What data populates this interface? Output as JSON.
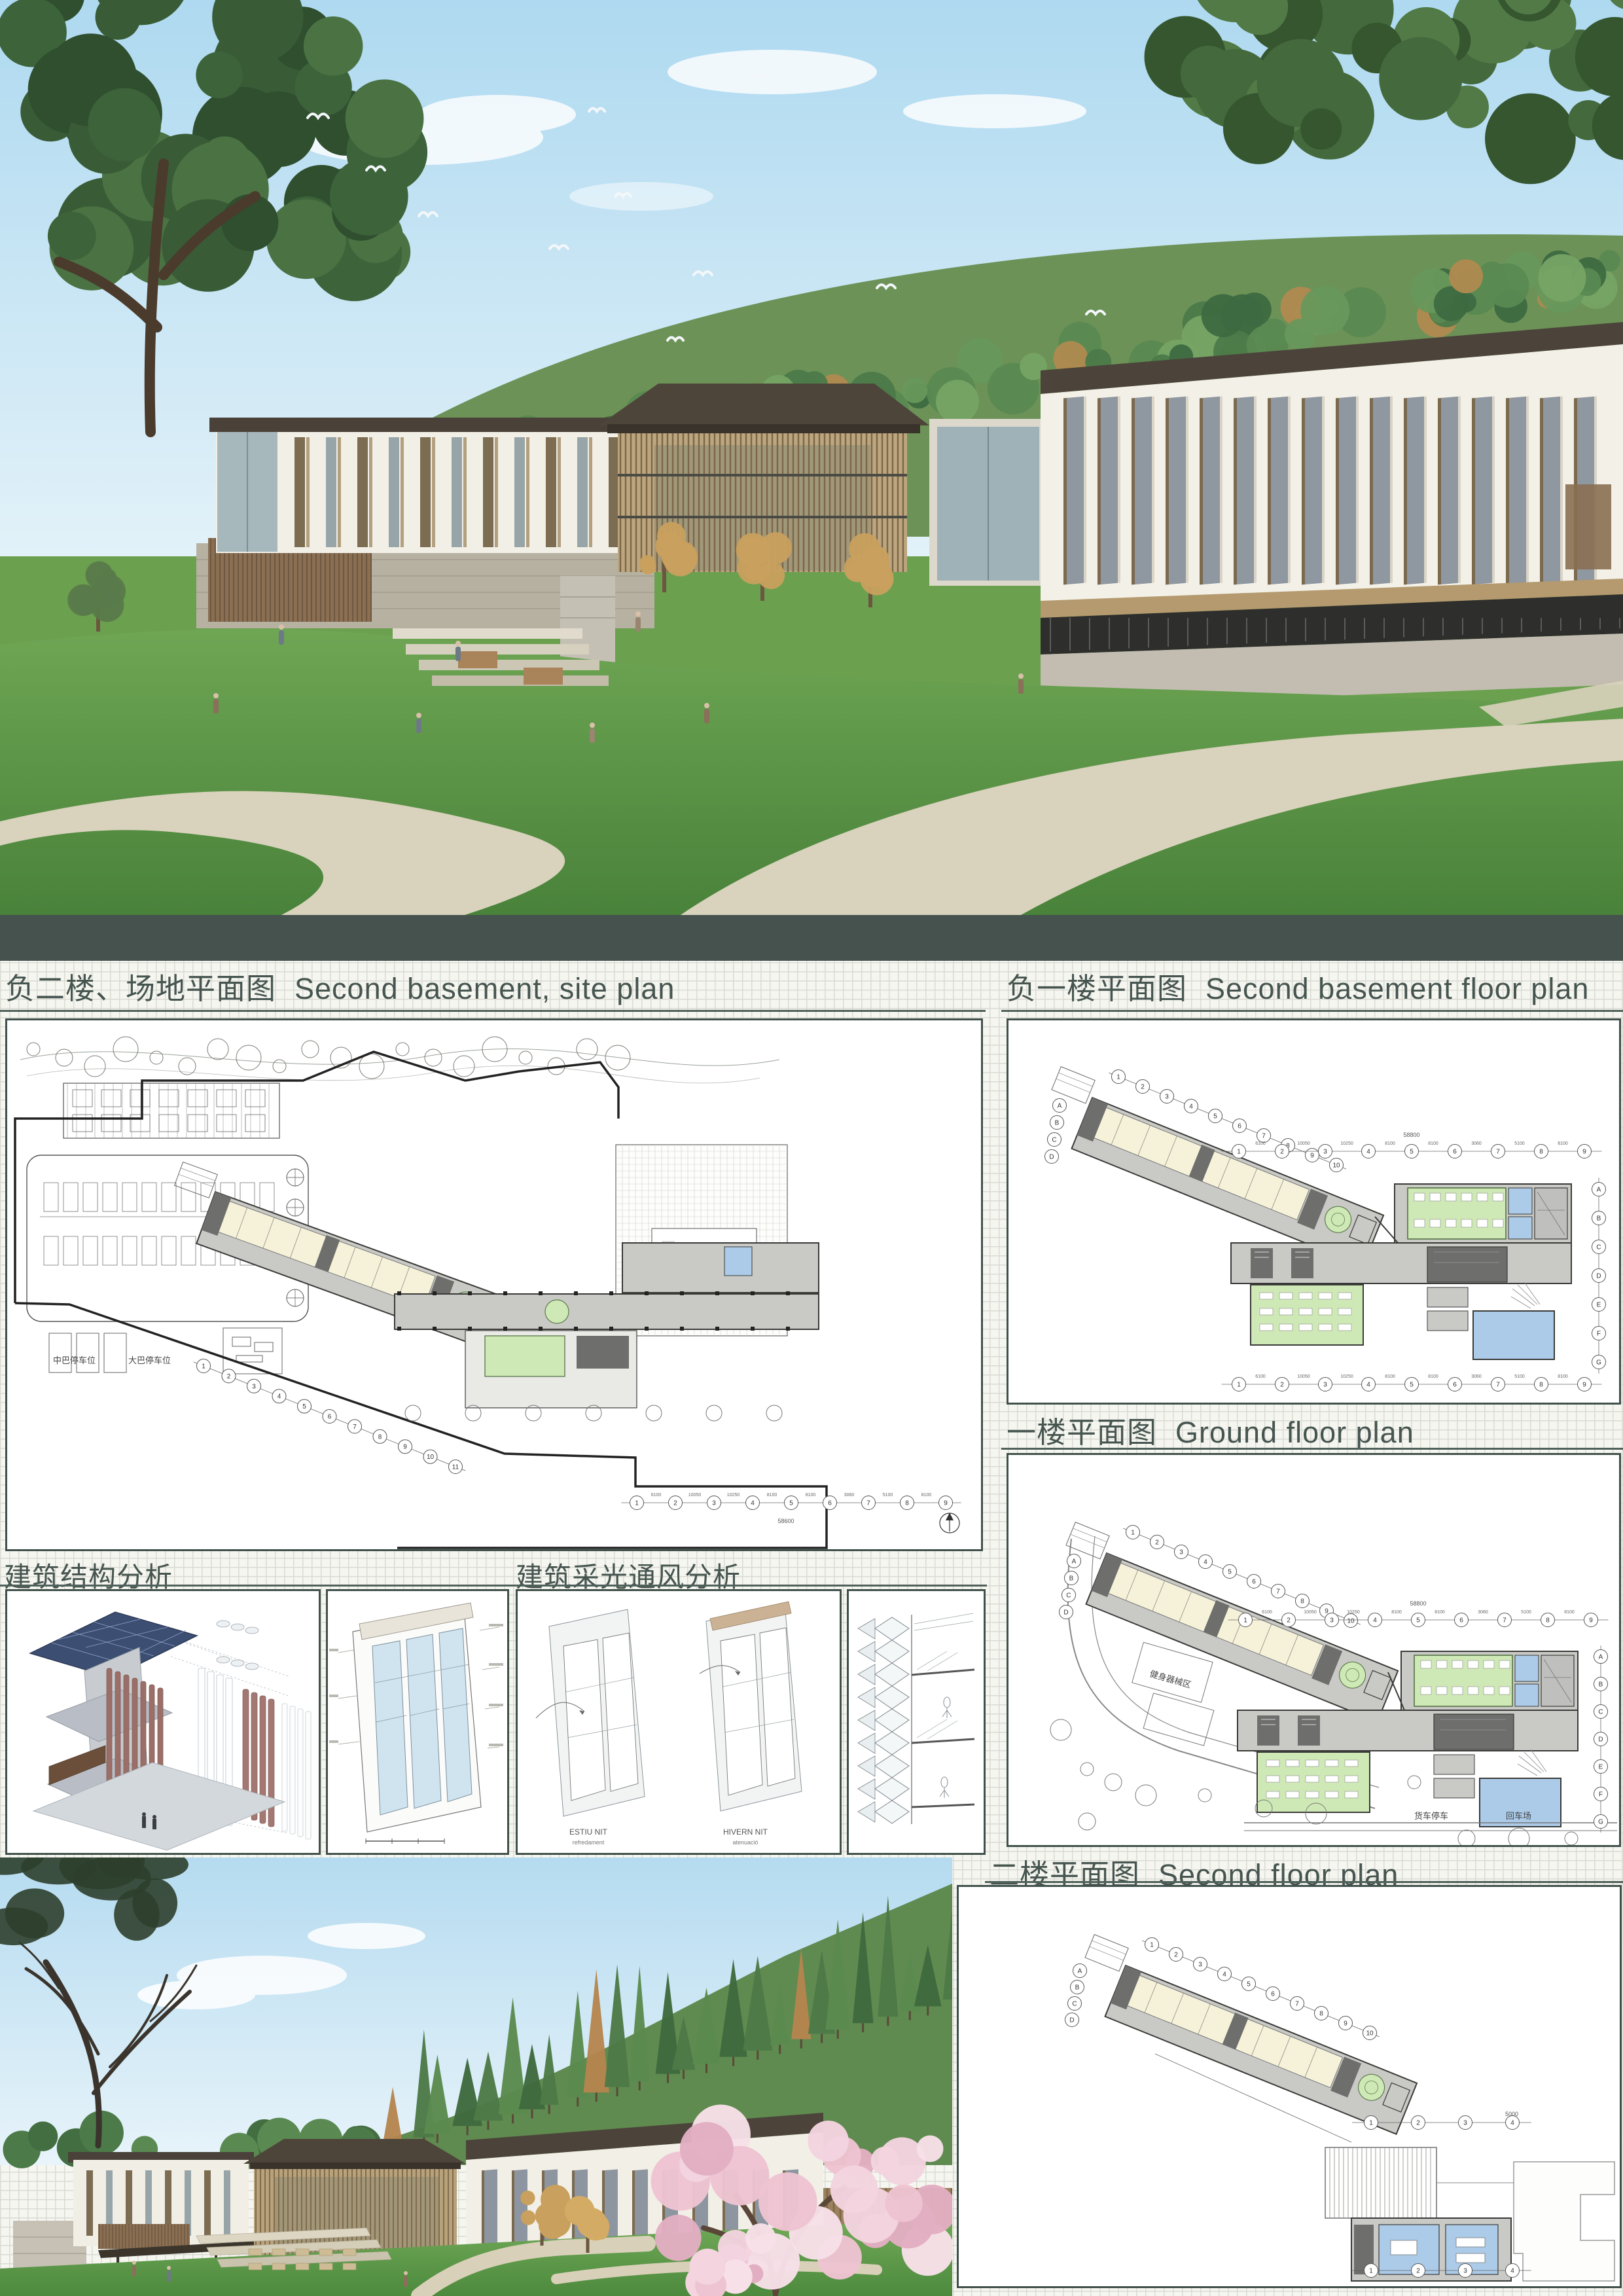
{
  "titles": {
    "site_zh": "负二楼、场地平面图",
    "site_en": "Second basement, site plan",
    "b1_zh": "负一楼平面图",
    "b1_en": "Second basement floor plan",
    "ground_zh": "一楼平面图",
    "ground_en": "Ground floor plan",
    "second_zh": "二楼平面图",
    "second_en": "Second floor plan",
    "structure_zh": "建筑结构分析",
    "daylight_zh": "建筑采光通风分析"
  },
  "site_plan": {
    "minibus_parking": "中巴停车位",
    "bus_parking": "大巴停车位",
    "total_dim": "58600"
  },
  "ground_plan": {
    "fitness_area": "健身器械区",
    "truck_parking": "货车停车",
    "turnaround": "回车场"
  },
  "plans": {
    "axes_n11": [
      "1",
      "2",
      "3",
      "4",
      "5",
      "6",
      "7",
      "8",
      "9",
      "10",
      "11"
    ],
    "axes_n10": [
      "1",
      "2",
      "3",
      "4",
      "5",
      "6",
      "7",
      "8",
      "9",
      "10"
    ],
    "axes_n9": [
      "1",
      "2",
      "3",
      "4",
      "5",
      "6",
      "7",
      "8",
      "9"
    ],
    "axes_n4": [
      "1",
      "2",
      "3",
      "4"
    ],
    "axes_letters": [
      "A",
      "B",
      "C",
      "D",
      "E",
      "F",
      "G"
    ],
    "axes_letters_wing": [
      "A",
      "B",
      "C",
      "D"
    ],
    "top_dims": [
      "6100",
      "10050",
      "10250",
      "8100",
      "8100",
      "3060",
      "5100",
      "8100"
    ],
    "total_dim": "58800",
    "wing_dim": "5000"
  },
  "analysis": {
    "estiu": "ESTIU NIT",
    "estiu_sub": "refredament",
    "hivern": "HIVERN NIT",
    "hivern_sub": "atenuació"
  },
  "colors": {
    "divider_band": "#45524e",
    "title_text": "#465550",
    "room_cream": "#f6f2da",
    "room_green": "#cfe9b6",
    "room_blue": "#abcbe9",
    "corridor": "#c9c9c6",
    "core": "#6e6e6c",
    "grid_line": "#d9dbd2",
    "sky": "#bfe0f2",
    "lawn": "#5d9346",
    "roof": "#4c443a",
    "louver_wood": "#8a6f52",
    "blossom_pink": "#eec3d2",
    "solar_blue": "#3c4e72"
  }
}
